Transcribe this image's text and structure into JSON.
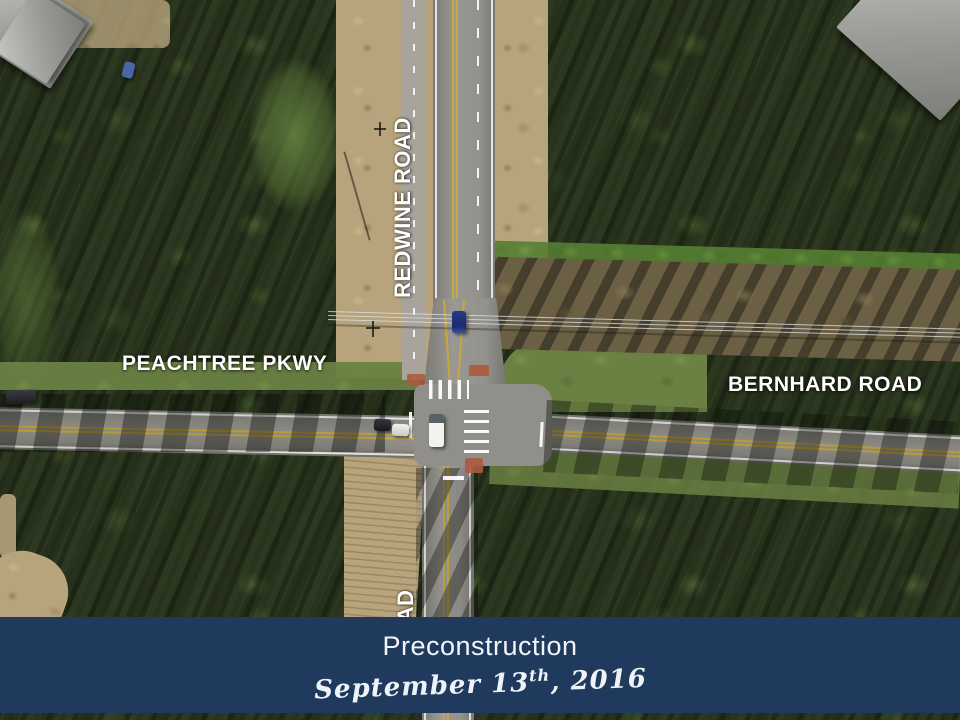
{
  "banner": {
    "title": "Preconstruction",
    "date_prefix": "September 13",
    "date_sup": "th",
    "date_suffix": ", 2016",
    "bg_color": "#1f3a5c"
  },
  "map": {
    "labels": {
      "redwine": "REDWINE ROAD",
      "redwine_partial": "AD",
      "peachtree": "PEACHTREE PKWY",
      "bernhard": "BERNHARD ROAD"
    },
    "label_color": "#ffffff"
  },
  "palette": {
    "forest_green": "#2c381f",
    "dirt_tan": "#b7a47c",
    "asphalt_gray": "#8e8d87",
    "grass_green": "#6a8143",
    "crosswalk_white": "#ffffff",
    "ramp_red": "#ab5a3e",
    "lane_yellow": "#c9a83c"
  }
}
